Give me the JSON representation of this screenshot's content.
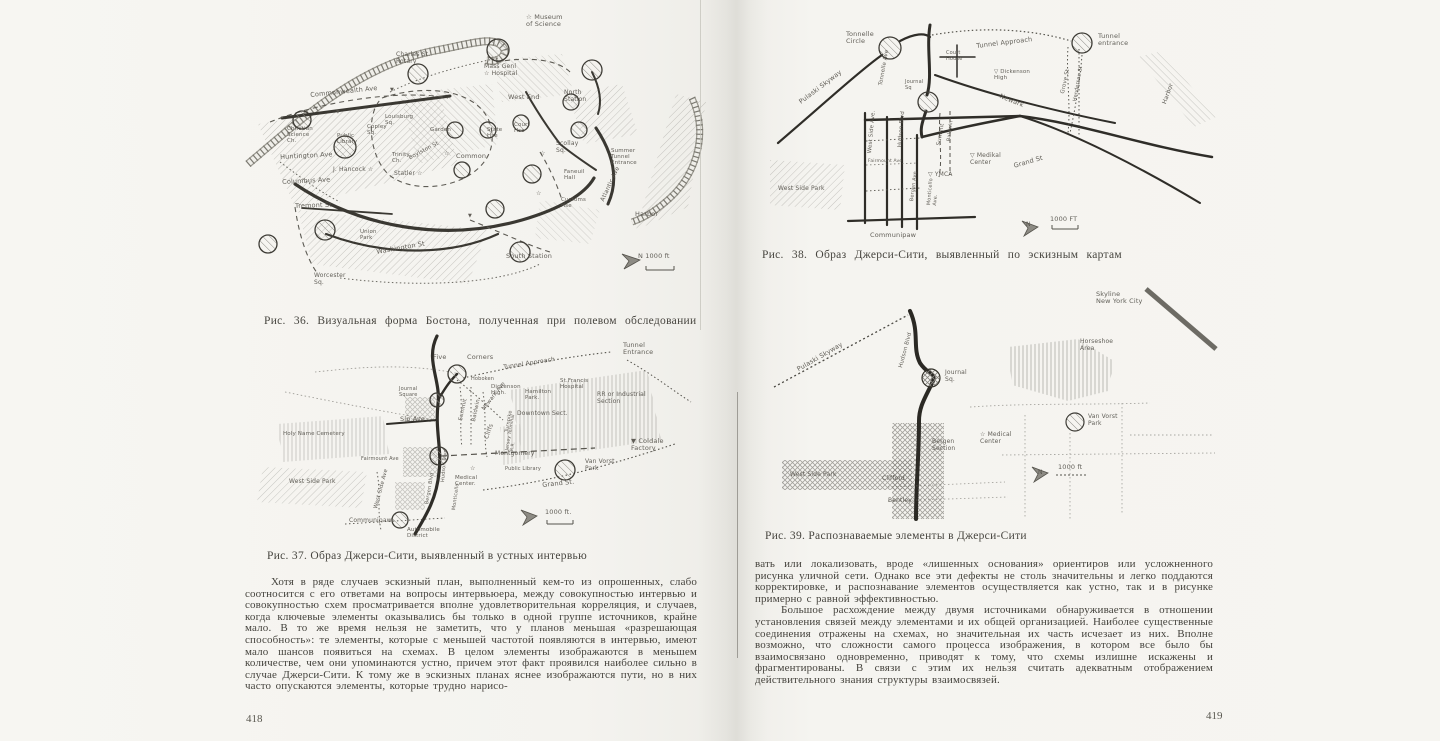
{
  "book": {
    "left_page": {
      "page_number": "418",
      "fig36": {
        "caption": "Рис. 36. Визуальная форма Бостона, полученная при полевом обследовании",
        "labels": [
          {
            "t": "☆ Museum\n   of Science",
            "x": 286,
            "y": 12
          },
          {
            "t": "Charles St.\nRotary",
            "x": 156,
            "y": 50,
            "s": 6
          },
          {
            "t": "Mass Genl\n☆ Hospital",
            "x": 244,
            "y": 62,
            "s": 6
          },
          {
            "t": "West  End",
            "x": 268,
            "y": 92
          },
          {
            "t": "North\nStation",
            "x": 324,
            "y": 88,
            "s": 6
          },
          {
            "t": "Louisburg\nSq.",
            "x": 145,
            "y": 112,
            "s": 5.5
          },
          {
            "t": "Commonwealth Ave",
            "x": 70,
            "y": 90,
            "r": -6
          },
          {
            "t": "Christian\nScience\nCh.",
            "x": 47,
            "y": 124,
            "s": 5.5
          },
          {
            "t": "Public\nLibrary",
            "x": 97,
            "y": 131,
            "s": 5.5
          },
          {
            "t": "Copley\nSq.",
            "x": 127,
            "y": 122,
            "s": 5.5
          },
          {
            "t": "Trinity\nCh.",
            "x": 152,
            "y": 150,
            "s": 5.5
          },
          {
            "t": "Huntington Ave",
            "x": 40,
            "y": 152,
            "r": -3
          },
          {
            "t": "J. Hancock ☆",
            "x": 93,
            "y": 165,
            "s": 6
          },
          {
            "t": "Statler ☆",
            "x": 154,
            "y": 169,
            "s": 6
          },
          {
            "t": "Columbus Ave",
            "x": 42,
            "y": 177,
            "r": -3
          },
          {
            "t": "Tremont  St",
            "x": 55,
            "y": 201,
            "r": -2
          },
          {
            "t": "Garden",
            "x": 190,
            "y": 125,
            "s": 5.5
          },
          {
            "t": "Common",
            "x": 216,
            "y": 151
          },
          {
            "t": "Boylston St",
            "x": 168,
            "y": 154,
            "r": -28,
            "s": 5.5
          },
          {
            "t": "State\nHse",
            "x": 247,
            "y": 125,
            "s": 5.5
          },
          {
            "t": "Court\nHse",
            "x": 274,
            "y": 120,
            "s": 5.5
          },
          {
            "t": "Scollay\nSq.",
            "x": 316,
            "y": 139,
            "s": 6
          },
          {
            "t": "Faneuil\nHall",
            "x": 324,
            "y": 167,
            "s": 5.5
          },
          {
            "t": "Summer\nTunnel\nEntrance",
            "x": 371,
            "y": 146,
            "s": 5.5
          },
          {
            "t": "Customs\nHse",
            "x": 321,
            "y": 195,
            "s": 5.5
          },
          {
            "t": "Atlantic Ave",
            "x": 360,
            "y": 198,
            "r": -65,
            "s": 6
          },
          {
            "t": "Harbor",
            "x": 395,
            "y": 209
          },
          {
            "t": "Union\nPark",
            "x": 120,
            "y": 227,
            "s": 5.5
          },
          {
            "t": "Washington St",
            "x": 136,
            "y": 247,
            "r": -10
          },
          {
            "t": "Worcester\nSq.",
            "x": 74,
            "y": 271,
            "s": 6
          },
          {
            "t": "South  Station",
            "x": 266,
            "y": 251
          },
          {
            "t": "N   1000 ft",
            "x": 398,
            "y": 251
          },
          {
            "t": "▼",
            "x": 150,
            "y": 86,
            "s": 5
          },
          {
            "t": "▼",
            "x": 96,
            "y": 108,
            "s": 5
          },
          {
            "t": "▼",
            "x": 228,
            "y": 212,
            "s": 5
          },
          {
            "t": "☆",
            "x": 204,
            "y": 149,
            "s": 6
          },
          {
            "t": "☆",
            "x": 300,
            "y": 149,
            "s": 6
          },
          {
            "t": "☆",
            "x": 296,
            "y": 189,
            "s": 6
          }
        ]
      },
      "fig37": {
        "caption": "Рис. 37. Образ Джерси-Сити, выявленный в устных интервью",
        "labels": [
          {
            "t": "Five",
            "x": 178,
            "y": 22
          },
          {
            "t": "Corners",
            "x": 212,
            "y": 22
          },
          {
            "t": "Tunnel  Approach",
            "x": 248,
            "y": 33,
            "r": -9,
            "s": 6
          },
          {
            "t": "Tunnel\nEntrance",
            "x": 368,
            "y": 10
          },
          {
            "t": "Hoboken",
            "x": 216,
            "y": 45,
            "s": 5
          },
          {
            "t": "Dickenson\nHigh.",
            "x": 236,
            "y": 52,
            "s": 5.5
          },
          {
            "t": "Hamilton\nPark.",
            "x": 270,
            "y": 57,
            "s": 5.5
          },
          {
            "t": "St.Francis\nHospital",
            "x": 305,
            "y": 46,
            "s": 5.5
          },
          {
            "t": "RR or Industrial\nSection",
            "x": 342,
            "y": 60,
            "s": 6
          },
          {
            "t": "Downtown Sect.",
            "x": 262,
            "y": 79,
            "s": 6
          },
          {
            "t": "Journal\nSquare",
            "x": 144,
            "y": 55,
            "s": 5
          },
          {
            "t": "Sip Ave",
            "x": 145,
            "y": 84
          },
          {
            "t": "Summit",
            "x": 203,
            "y": 88,
            "r": -78,
            "s": 5.5
          },
          {
            "t": "Baldwin",
            "x": 216,
            "y": 89,
            "r": -78,
            "s": 5.5
          },
          {
            "t": "Newark Ave",
            "x": 226,
            "y": 76,
            "r": -52,
            "s": 5.5
          },
          {
            "t": "Turnpike",
            "x": 250,
            "y": 100,
            "r": -80,
            "s": 5
          },
          {
            "t": "Cliffs",
            "x": 229,
            "y": 106,
            "r": -70,
            "s": 6
          },
          {
            "t": "Jersey Terminal\nR.R.",
            "x": 250,
            "y": 118,
            "r": -80,
            "s": 4.5
          },
          {
            "t": "Montgomery",
            "x": 240,
            "y": 119,
            "s": 6
          },
          {
            "t": "Holy  Name  Cemetery",
            "x": 28,
            "y": 99,
            "s": 5.5
          },
          {
            "t": "Fairmount Ave",
            "x": 106,
            "y": 125,
            "s": 5
          },
          {
            "t": "West  Side  Park",
            "x": 34,
            "y": 147,
            "s": 6
          },
          {
            "t": "West Side Ave",
            "x": 118,
            "y": 176,
            "r": -75,
            "s": 5.5
          },
          {
            "t": "Hudson Blvd",
            "x": 186,
            "y": 150,
            "r": -85,
            "s": 5
          },
          {
            "t": "Bergen Blvd",
            "x": 170,
            "y": 172,
            "r": -80,
            "s": 5
          },
          {
            "t": "Monticello",
            "x": 197,
            "y": 178,
            "r": -82,
            "s": 5
          },
          {
            "t": "Medical\nCenter.",
            "x": 200,
            "y": 143,
            "s": 5.5
          },
          {
            "t": "☆",
            "x": 215,
            "y": 134,
            "s": 6
          },
          {
            "t": "Communipaw",
            "x": 94,
            "y": 186,
            "s": 6
          },
          {
            "t": "Automobile\nDistrict",
            "x": 152,
            "y": 195,
            "s": 5.5
          },
          {
            "t": "Public Library",
            "x": 250,
            "y": 135,
            "s": 5
          },
          {
            "t": "Van Vorst\nPark",
            "x": 330,
            "y": 127,
            "s": 6
          },
          {
            "t": "Grand St.",
            "x": 287,
            "y": 150,
            "r": -6
          },
          {
            "t": "▼ Coldale\n    Factory",
            "x": 376,
            "y": 106
          },
          {
            "t": "1000 ft.",
            "x": 290,
            "y": 177
          }
        ]
      },
      "body": "Хотя в ряде случаев эскизный план, выполненный кем-то из опрошенных, слабо соотносится с его ответами на вопросы интервьюера, между совокупностью интервью и совокупностью схем просматривается вполне удовлетворительная корреляция, и случаев, когда ключевые элементы оказывались бы только в одной группе источников, крайне мало. В то же время нельзя не заметить, что у планов меньшая «разрешающая способность»: те элементы, которые с меньшей частотой появляются в интервью, имеют мало шансов появиться на схемах. В целом элементы изображаются в меньшем количестве, чем они упоминаются устно, причем этот факт проявился наиболее сильно в случае Джерси-Сити. К тому же в эскизных планах яснее изображаются пути, но в них часто опускаются элементы, которые трудно нарисо-"
    },
    "right_page": {
      "page_number": "419",
      "fig38": {
        "caption": "Рис. 38. Образ Джерси-Сити, выявленный по эскизным картам",
        "labels": [
          {
            "t": "Tonnelle\nCircle",
            "x": 76,
            "y": 26
          },
          {
            "t": "Pulaski  Skyway",
            "x": 28,
            "y": 95,
            "r": -37
          },
          {
            "t": "Tonnelle Ave",
            "x": 108,
            "y": 80,
            "r": -80,
            "s": 5.5
          },
          {
            "t": "Tunnel  Approach",
            "x": 206,
            "y": 38,
            "r": -7
          },
          {
            "t": "Tunnel\nentrance",
            "x": 328,
            "y": 28
          },
          {
            "t": "Court\nHouse",
            "x": 176,
            "y": 46,
            "s": 5
          },
          {
            "t": "▽ Dickenson\n    High",
            "x": 224,
            "y": 64,
            "s": 5.5
          },
          {
            "t": "Newark",
            "x": 231,
            "y": 88,
            "r": 22
          },
          {
            "t": "Journal\nSq",
            "x": 135,
            "y": 75,
            "s": 5
          },
          {
            "t": "Grove St",
            "x": 290,
            "y": 88,
            "r": -78,
            "s": 5.5
          },
          {
            "t": "Henderson St",
            "x": 303,
            "y": 96,
            "r": -80,
            "s": 5
          },
          {
            "t": "West Side Ave.",
            "x": 97,
            "y": 148,
            "r": -85,
            "s": 5.5
          },
          {
            "t": "Hudson Blvd",
            "x": 127,
            "y": 142,
            "r": -85,
            "s": 5.5
          },
          {
            "t": "Summit",
            "x": 166,
            "y": 140,
            "r": -80,
            "s": 5.5
          },
          {
            "t": "Baldwin",
            "x": 177,
            "y": 136,
            "r": -83,
            "s": 5
          },
          {
            "t": "▽ Medikal\n   Center",
            "x": 200,
            "y": 148,
            "s": 6
          },
          {
            "t": "Grand  St",
            "x": 243,
            "y": 158,
            "r": -16
          },
          {
            "t": "Fairmount Ave",
            "x": 98,
            "y": 154,
            "s": 4.5
          },
          {
            "t": "▽ YMCA",
            "x": 158,
            "y": 167,
            "s": 6
          },
          {
            "t": "Bergen Ave",
            "x": 140,
            "y": 196,
            "r": -83,
            "s": 5
          },
          {
            "t": "Monticello\nAve.",
            "x": 157,
            "y": 200,
            "r": -85,
            "s": 5
          },
          {
            "t": "West  Side  Park",
            "x": 8,
            "y": 181,
            "s": 6
          },
          {
            "t": "Communipaw",
            "x": 100,
            "y": 227
          },
          {
            "t": "Harbor",
            "x": 392,
            "y": 98,
            "r": -70,
            "s": 6
          },
          {
            "t": "N",
            "x": 256,
            "y": 217,
            "s": 6
          },
          {
            "t": "1000 FT",
            "x": 280,
            "y": 211
          }
        ]
      },
      "fig39": {
        "caption": "Рис. 39. Распознаваемые элементы в Джерси-Сити",
        "labels": [
          {
            "t": "Skyline\nNew York City",
            "x": 326,
            "y": 6
          },
          {
            "t": "Pulaski  Skyway",
            "x": 26,
            "y": 82,
            "r": -30
          },
          {
            "t": "Hudson Blvd",
            "x": 128,
            "y": 82,
            "r": -75,
            "s": 5.5
          },
          {
            "t": "Journal\nSq.",
            "x": 175,
            "y": 85,
            "s": 6
          },
          {
            "t": "Horseshoe\nArea",
            "x": 310,
            "y": 54,
            "s": 6
          },
          {
            "t": "Van Vorst\nPark",
            "x": 318,
            "y": 129,
            "s": 6
          },
          {
            "t": "☆ Medical\n    Center",
            "x": 210,
            "y": 147,
            "s": 6
          },
          {
            "t": "Bergen\nSection",
            "x": 162,
            "y": 154,
            "s": 6
          },
          {
            "t": "West  Side  Park",
            "x": 20,
            "y": 187,
            "s": 6
          },
          {
            "t": "Clifford",
            "x": 112,
            "y": 191,
            "s": 6
          },
          {
            "t": "Bentley",
            "x": 118,
            "y": 213,
            "s": 6
          },
          {
            "t": "N",
            "x": 268,
            "y": 185,
            "s": 6
          },
          {
            "t": "1000 ft",
            "x": 288,
            "y": 179
          }
        ]
      },
      "body_p1": "вать или локализовать, вроде «лишенных основания» ориентиров или усложненного рисунка уличной сети. Однако все эти дефекты не столь значительны и легко поддаются корректировке, и распознавание элементов осуществляется как устно, так и в рисунке примерно с равной эффективностью.",
      "body_p2": "Большое расхождение между двумя источниками обнаруживается в отношении установления связей между элементами и их общей организацией. Наиболее существенные соединения отражены на схемах, но значительная их часть исчезает из них. Вполне возможно, что сложности самого процесса изображения, в котором все было бы взаимосвязано одновременно, приводят к тому, что схемы излишне искажены и фрагментированы. В связи с этим их нельзя считать адекватным отображением действительного знания структуры взаимосвязей."
    }
  }
}
